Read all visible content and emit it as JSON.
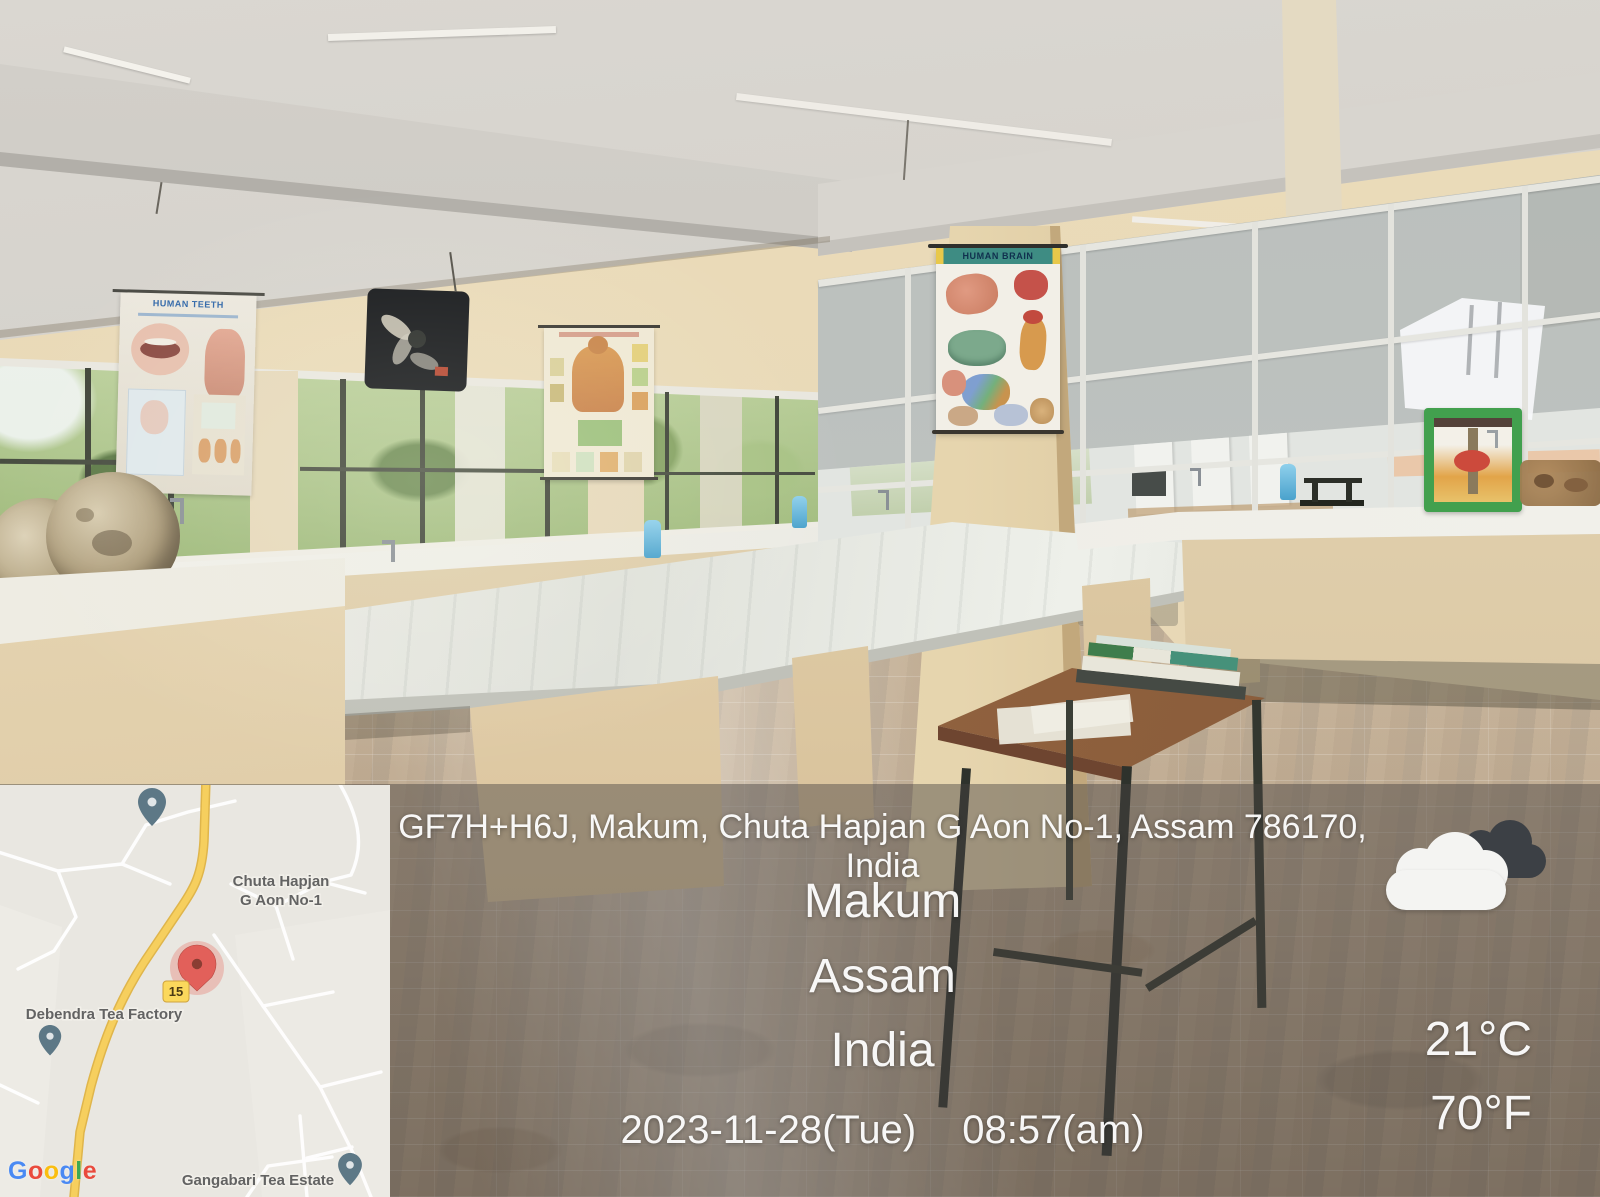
{
  "overlay": {
    "address": "GF7H+H6J, Makum, Chuta Hapjan G Aon No-1, Assam 786170, India",
    "city": "Makum",
    "state": "Assam",
    "country": "India",
    "date": "2023-11-28(Tue)",
    "time": "08:57(am)",
    "temperature_c": "21°C",
    "temperature_f": "70°F",
    "weather_icon": "cloudy-icon"
  },
  "map": {
    "place_line1": "Chuta Hapjan",
    "place_line2": "G Aon No-1",
    "poi_left": "Debendra Tea Factory",
    "poi_bottom": "Gangabari Tea Estate",
    "route_badge": "15",
    "attribution_letters": [
      {
        "ch": "G",
        "color": "#4285F4"
      },
      {
        "ch": "o",
        "color": "#EA4335"
      },
      {
        "ch": "o",
        "color": "#FBBC05"
      },
      {
        "ch": "g",
        "color": "#4285F4"
      },
      {
        "ch": "l",
        "color": "#34A853"
      },
      {
        "ch": "e",
        "color": "#EA4335"
      }
    ]
  },
  "scene": {
    "posters": {
      "brain_title": "HUMAN BRAIN",
      "teeth_title": "HUMAN TEETH"
    }
  },
  "colors": {
    "pin_red": "#E2605A",
    "pin_red_dot": "#8A3D33",
    "pin_gray": "#5D7886",
    "route_yellow": "#FBD85C",
    "overlay_shade": "rgba(70,67,64,0.45)"
  }
}
